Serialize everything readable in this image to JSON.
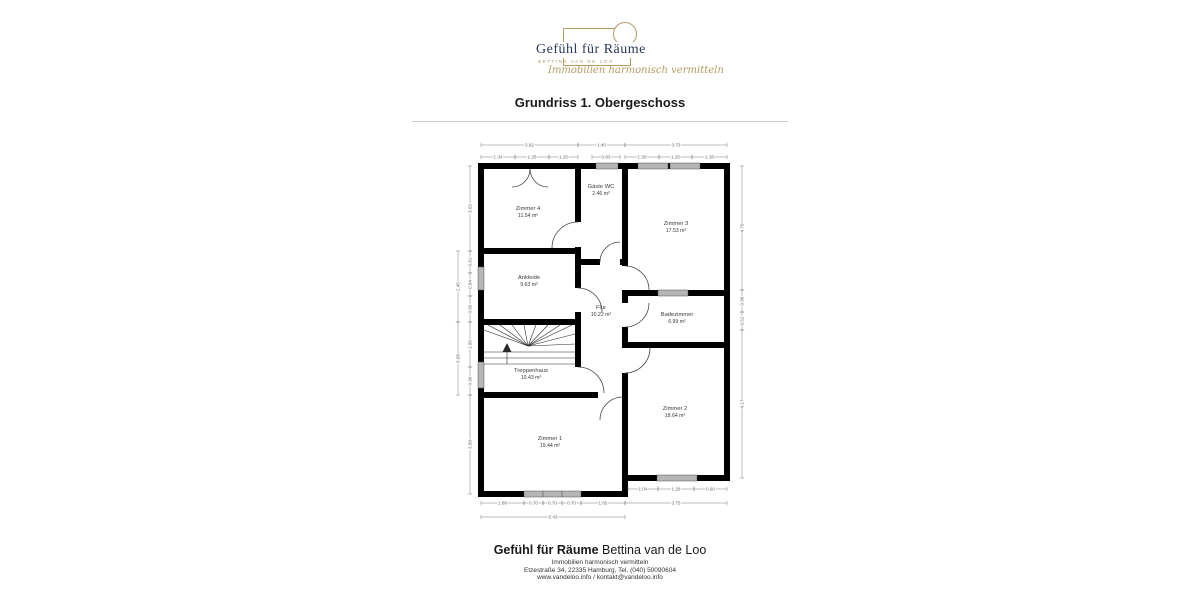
{
  "title": "Grundriss 1. Obergeschoss",
  "logo": {
    "brand": "Gefühl für Räume",
    "subbrand": "BETTINA VAN DE LOO",
    "tagline": "Immobilien harmonisch vermitteln",
    "accent_color": "#b49a5f",
    "brand_color": "#28395c"
  },
  "footer": {
    "brand_bold": "Gefühl für Räume",
    "brand_rest": " Bettina van de Loo",
    "line1": "Immobilien harmonisch vermitteln",
    "line2": "Etzestraße 34, 22335 Hamburg, Tel. (040) 50090604",
    "line3": "www.vandeloo.info / kontakt@vandeloo.info"
  },
  "floorplan": {
    "colors": {
      "wall": "#000000",
      "window": "#b5b5b5",
      "window_edge": "#555555",
      "dimension": "#6a6a6a",
      "dimension_line": "#7a7a7a",
      "label": "#3a3a3a",
      "door": "#444444",
      "stairs": "#2a2a2a"
    },
    "rooms": [
      {
        "name": "Zimmer 4",
        "area": "11.54 m²",
        "x": 528,
        "y": 210
      },
      {
        "name": "Gäste WC",
        "area": "2.46 m²",
        "x": 601,
        "y": 188
      },
      {
        "name": "Zimmer 3",
        "area": "17.53 m²",
        "x": 676,
        "y": 225
      },
      {
        "name": "Ankleide",
        "area": "9.63 m²",
        "x": 529,
        "y": 279
      },
      {
        "name": "Flur",
        "area": "10.22 m²",
        "x": 601,
        "y": 309
      },
      {
        "name": "Badezimmer",
        "area": "6.99 m²",
        "x": 677,
        "y": 316
      },
      {
        "name": "Treppenhaus",
        "area": "10.43 m²",
        "x": 531,
        "y": 372
      },
      {
        "name": "Zimmer 1",
        "area": "19.44 m²",
        "x": 550,
        "y": 440
      },
      {
        "name": "Zimmer 2",
        "area": "18.64 m²",
        "x": 675,
        "y": 410
      }
    ],
    "walls": [
      [
        478,
        163,
        252,
        6
      ],
      [
        478,
        163,
        6,
        334
      ],
      [
        724,
        163,
        6,
        318
      ],
      [
        478,
        491,
        150,
        6
      ],
      [
        622,
        475,
        108,
        6
      ],
      [
        575,
        169,
        6,
        53
      ],
      [
        575,
        247,
        6,
        41
      ],
      [
        575,
        312,
        6,
        55
      ],
      [
        622,
        169,
        6,
        97
      ],
      [
        622,
        290,
        6,
        13
      ],
      [
        622,
        327,
        6,
        21
      ],
      [
        622,
        373,
        6,
        118
      ],
      [
        478,
        248,
        103,
        6
      ],
      [
        478,
        319,
        103,
        6
      ],
      [
        575,
        259,
        25,
        6
      ],
      [
        620,
        259,
        8,
        6
      ],
      [
        622,
        290,
        108,
        6
      ],
      [
        622,
        342,
        108,
        6
      ],
      [
        478,
        392,
        120,
        6
      ]
    ],
    "windows": [
      [
        596,
        163,
        22,
        6
      ],
      [
        638,
        163,
        30,
        6
      ],
      [
        670,
        163,
        30,
        6
      ],
      [
        478,
        267,
        6,
        23
      ],
      [
        478,
        362,
        6,
        26
      ],
      [
        524,
        491,
        19,
        6
      ],
      [
        543,
        491,
        19,
        6
      ],
      [
        562,
        491,
        19,
        6
      ],
      [
        657,
        475,
        40,
        6
      ],
      [
        658,
        290,
        30,
        6
      ]
    ],
    "doors": [
      "M 512 187 A 18 18 0 0 0 530 169",
      "M 548 187 A 18 18 0 0 1 530 169",
      "M 578 222 A 26 26 0 0 0 552 248",
      "M 600 262 A 20 20 0 0 1 620 242",
      "M 578 288 A 24 24 0 0 1 602 312",
      "M 625 266 A 24 24 0 0 1 649 290",
      "M 625 327 A 24 24 0 0 0 649 303",
      "M 625 373 A 25 25 0 0 0 650 348",
      "M 578 367 A 26 26 0 0 1 604 393",
      "M 623 397 A 23 23 0 0 0 600 420"
    ],
    "stair_lines": [
      [
        528,
        346,
        484,
        330
      ],
      [
        528,
        346,
        488,
        325
      ],
      [
        528,
        346,
        500,
        325
      ],
      [
        528,
        346,
        512,
        325
      ],
      [
        528,
        346,
        524,
        325
      ],
      [
        528,
        346,
        536,
        325
      ],
      [
        528,
        346,
        548,
        325
      ],
      [
        528,
        346,
        560,
        325
      ],
      [
        528,
        346,
        572,
        325
      ],
      [
        528,
        346,
        575,
        334
      ],
      [
        528,
        346,
        575,
        344
      ],
      [
        484,
        352,
        575,
        352
      ],
      [
        484,
        358,
        575,
        358
      ],
      [
        484,
        364,
        575,
        364
      ],
      [
        507,
        364,
        507,
        348
      ]
    ],
    "stair_arrow": "M 507 343 L 502.5 352 L 511.5 352 Z",
    "dimensions": [
      {
        "t": "3.82",
        "o": "h",
        "a": 481,
        "b": 578,
        "p": 145
      },
      {
        "t": "1.40",
        "o": "h",
        "a": 578,
        "b": 625,
        "p": 145
      },
      {
        "t": "3.73",
        "o": "h",
        "a": 625,
        "b": 727,
        "p": 145
      },
      {
        "t": "1.34",
        "o": "h",
        "a": 481,
        "b": 515,
        "p": 157
      },
      {
        "t": "1.25",
        "o": "h",
        "a": 515,
        "b": 549,
        "p": 157
      },
      {
        "t": "1.25",
        "o": "h",
        "a": 549,
        "b": 578,
        "p": 157
      },
      {
        "t": "0.83",
        "o": "h",
        "a": 592,
        "b": 620,
        "p": 157
      },
      {
        "t": "1.30",
        "o": "h",
        "a": 625,
        "b": 659,
        "p": 157
      },
      {
        "t": "1.25",
        "o": "h",
        "a": 659,
        "b": 692,
        "p": 157
      },
      {
        "t": "1.38",
        "o": "h",
        "a": 692,
        "b": 727,
        "p": 157
      },
      {
        "t": "3.02",
        "o": "v",
        "a": 166,
        "b": 251,
        "p": 470
      },
      {
        "t": "0.81",
        "o": "v",
        "a": 251,
        "b": 273,
        "p": 470
      },
      {
        "t": "0.84",
        "o": "v",
        "a": 273,
        "b": 296,
        "p": 470
      },
      {
        "t": "0.80",
        "o": "v",
        "a": 296,
        "b": 322,
        "p": 470
      },
      {
        "t": "1.95",
        "o": "v",
        "a": 322,
        "b": 367,
        "p": 470
      },
      {
        "t": "0.90",
        "o": "v",
        "a": 367,
        "b": 395,
        "p": 470
      },
      {
        "t": "3.58",
        "o": "v",
        "a": 395,
        "b": 494,
        "p": 470
      },
      {
        "t": "2.45",
        "o": "v",
        "a": 251,
        "b": 322,
        "p": 458
      },
      {
        "t": "3.08",
        "o": "v",
        "a": 322,
        "b": 395,
        "p": 458
      },
      {
        "t": "4.70",
        "o": "v",
        "a": 166,
        "b": 290,
        "p": 742
      },
      {
        "t": "0.98",
        "o": "v",
        "a": 290,
        "b": 312,
        "p": 742
      },
      {
        "t": "0.52",
        "o": "v",
        "a": 312,
        "b": 330,
        "p": 742
      },
      {
        "t": "4.17",
        "o": "v",
        "a": 330,
        "b": 478,
        "p": 742
      },
      {
        "t": "1.04",
        "o": "h",
        "a": 628,
        "b": 658,
        "p": 489
      },
      {
        "t": "1.28",
        "o": "h",
        "a": 658,
        "b": 694,
        "p": 489
      },
      {
        "t": "0.90",
        "o": "h",
        "a": 694,
        "b": 727,
        "p": 489
      },
      {
        "t": "3.75",
        "o": "h",
        "a": 625,
        "b": 727,
        "p": 503
      },
      {
        "t": "1.68",
        "o": "h",
        "a": 481,
        "b": 524,
        "p": 503
      },
      {
        "t": "0.70",
        "o": "h",
        "a": 524,
        "b": 543,
        "p": 503
      },
      {
        "t": "0.70",
        "o": "h",
        "a": 543,
        "b": 562,
        "p": 503
      },
      {
        "t": "0.70",
        "o": "h",
        "a": 562,
        "b": 581,
        "p": 503
      },
      {
        "t": "1.65",
        "o": "h",
        "a": 581,
        "b": 625,
        "p": 503
      },
      {
        "t": "5.43",
        "o": "h",
        "a": 481,
        "b": 625,
        "p": 517
      }
    ]
  }
}
